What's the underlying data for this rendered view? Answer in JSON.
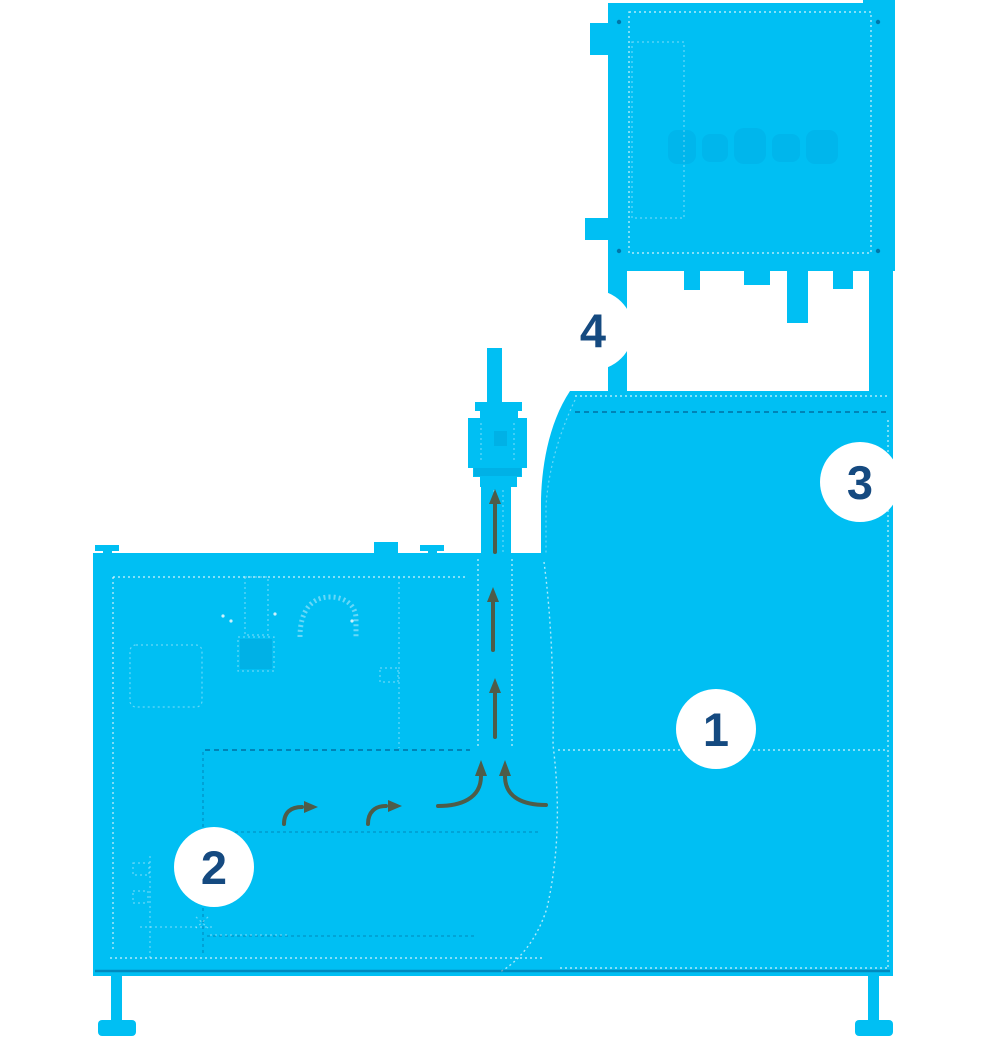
{
  "theme": {
    "page-bg": "#FFFFFF",
    "machine-cyan": "#00BFF3",
    "arrow-color": "#4E5C49",
    "badge-bg": "#FFFFFF",
    "badge-number-color": "#154A80"
  },
  "callouts": [
    {
      "label": "1"
    },
    {
      "label": "2"
    },
    {
      "label": "3"
    },
    {
      "label": "4"
    }
  ]
}
